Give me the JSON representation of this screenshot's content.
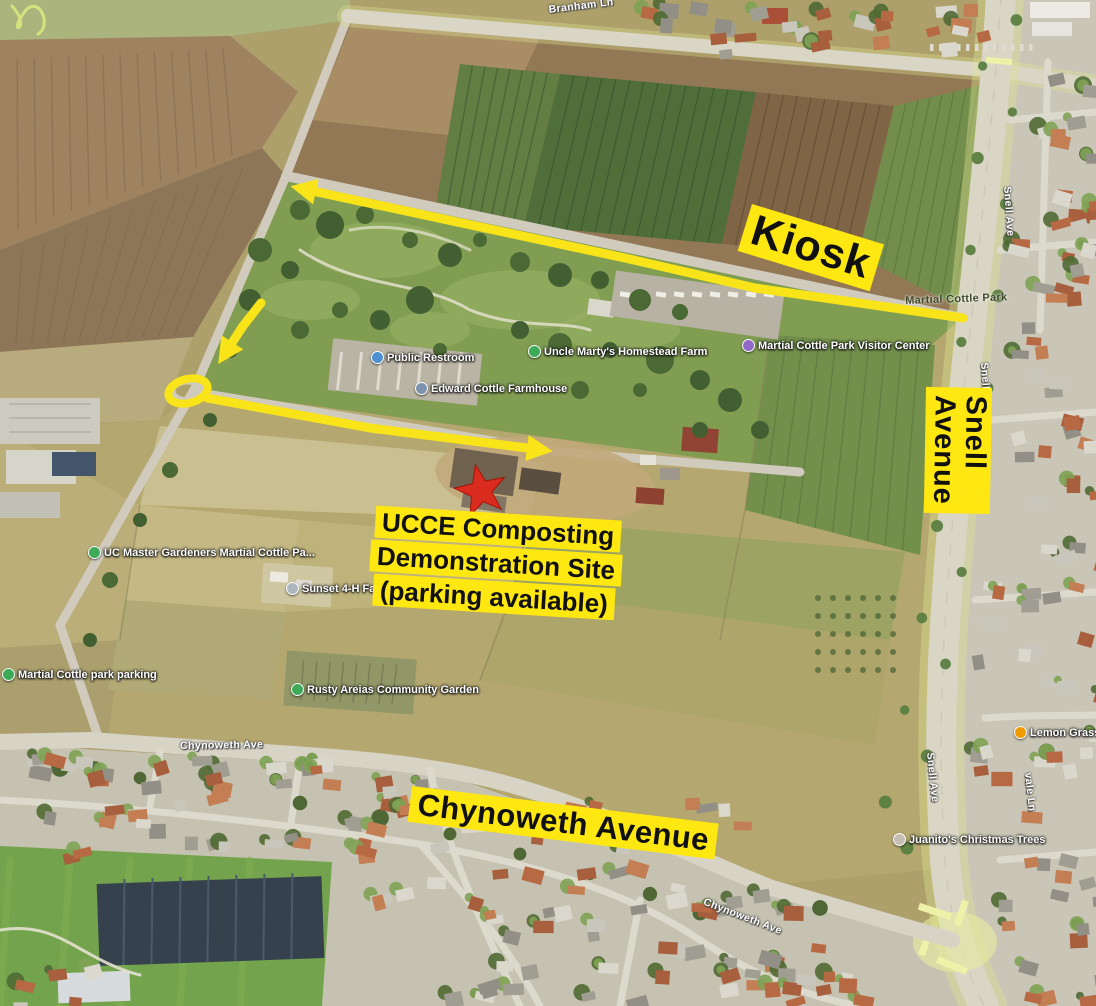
{
  "annotations": {
    "kiosk": "Kiosk",
    "snell": "Snell Avenue",
    "chynoweth": "Chynoweth Avenue",
    "site_lines": [
      "UCCE Composting",
      "Demonstration Site",
      "(parking available)"
    ],
    "highlight_color": "#ffe712",
    "arrow_color": "#f8e418",
    "star_color": "#d92b1e"
  },
  "route": {
    "arrows": [
      {
        "name": "route-arrow-west-along-park-road",
        "points": [
          [
            963,
            318
          ],
          [
            755,
            288
          ],
          [
            625,
            258
          ],
          [
            308,
            190
          ]
        ]
      },
      {
        "name": "route-arrow-turn-south",
        "points": [
          [
            261,
            303
          ],
          [
            243,
            326
          ],
          [
            228,
            349
          ]
        ]
      },
      {
        "name": "route-arrow-east-to-site",
        "points": [
          [
            207,
            398
          ],
          [
            370,
            428
          ],
          [
            535,
            449
          ]
        ]
      }
    ],
    "roundabout": {
      "cx": 188,
      "cy": 391,
      "rx": 20,
      "ry": 12,
      "rotate": -15
    },
    "star": {
      "x": 481,
      "y": 491,
      "outer": 27,
      "inner": 11,
      "rotate": -12
    }
  },
  "map_labels": {
    "park_names": [
      {
        "text": "Martial Cottle Park",
        "x": 905,
        "y": 295,
        "rotate": -2
      }
    ],
    "streets": [
      {
        "text": "Branham Ln",
        "x": 548,
        "y": 4,
        "rotate": -7
      },
      {
        "text": "Snell Ave",
        "x": 1013,
        "y": 186,
        "rotate": 86
      },
      {
        "text": "Snell Ave",
        "x": 990,
        "y": 362,
        "rotate": 86
      },
      {
        "text": "Snell Ave",
        "x": 936,
        "y": 752,
        "rotate": 84
      },
      {
        "text": "vale Ln",
        "x": 1034,
        "y": 772,
        "rotate": 84
      },
      {
        "text": "Chynoweth Ave",
        "x": 180,
        "y": 740,
        "rotate": -1
      },
      {
        "text": "Chynoweth Ave",
        "x": 706,
        "y": 896,
        "rotate": 21
      }
    ],
    "pois": [
      {
        "text": "Public Restroom",
        "x": 371,
        "y": 351,
        "icon_color": "#4e8fd1",
        "name": "public-restroom"
      },
      {
        "text": "Edward Cottle Farmhouse",
        "x": 415,
        "y": 382,
        "icon_color": "#7d93ad",
        "name": "cottle-farmhouse"
      },
      {
        "text": "Uncle Marty's Homestead Farm",
        "x": 528,
        "y": 345,
        "icon_color": "#3daa58",
        "name": "homestead-farm"
      },
      {
        "text": "Martial Cottle Park Visitor Center",
        "x": 742,
        "y": 339,
        "icon_color": "#9069c8",
        "name": "visitor-center"
      },
      {
        "text": "UC Master Gardeners Martial Cottle Pa...",
        "x": 88,
        "y": 546,
        "icon_color": "#3daa58",
        "name": "uc-master-gardeners"
      },
      {
        "text": "Sunset 4-H Farm",
        "x": 286,
        "y": 582,
        "icon_color": "#aeb6bd",
        "name": "sunset-4h-farm"
      },
      {
        "text": "Rusty Areias Community Garden",
        "x": 291,
        "y": 683,
        "icon_color": "#3daa58",
        "name": "community-garden"
      },
      {
        "text": "Martial Cottle park parking",
        "x": 2,
        "y": 668,
        "icon_color": "#3daa58",
        "name": "park-parking"
      },
      {
        "text": "Lemon Grass",
        "x": 1014,
        "y": 726,
        "icon_color": "#f29b00",
        "name": "lemon-grass"
      },
      {
        "text": "Juanito's Christmas Trees",
        "x": 893,
        "y": 833,
        "icon_color": "#c6beb2",
        "name": "christmas-trees"
      }
    ]
  }
}
